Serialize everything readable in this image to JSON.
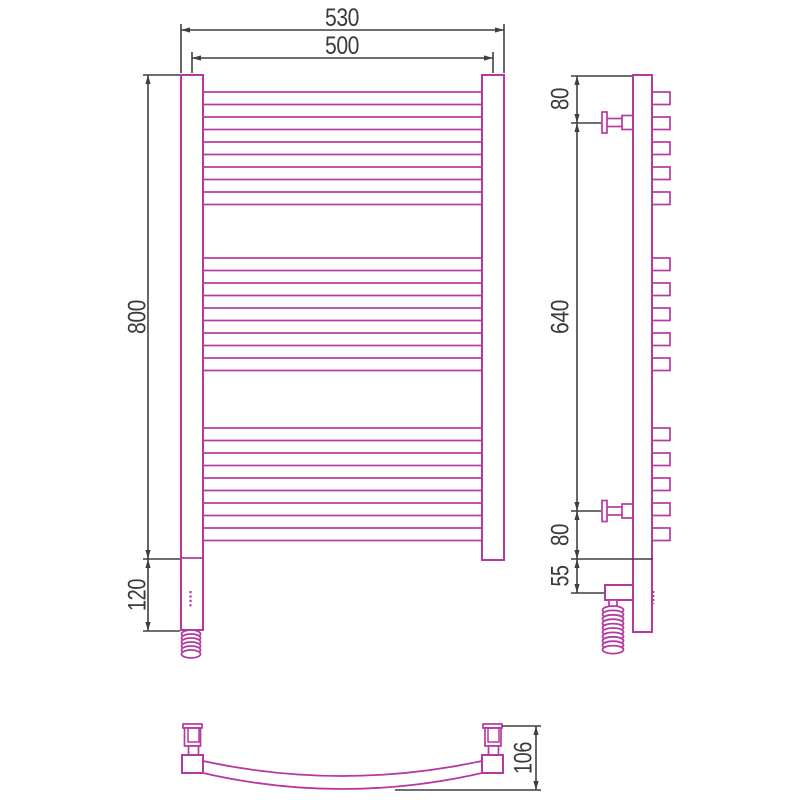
{
  "drawing": {
    "type": "technical-drawing",
    "subject": "curved-towel-rail-radiator",
    "colors": {
      "object_outline": "#b5399f",
      "dimension_lines": "#3f3f3f",
      "background": "#ffffff"
    },
    "front_view": {
      "dim_overall_width": "530",
      "dim_center_width": "500",
      "dim_height": "800",
      "dim_bottom_section": "120"
    },
    "side_view": {
      "dim_top_to_bracket": "80",
      "dim_bracket_span": "640",
      "dim_bracket_to_bottom": "80",
      "dim_element_offset": "55"
    },
    "bottom_view": {
      "dim_depth": "106"
    }
  }
}
